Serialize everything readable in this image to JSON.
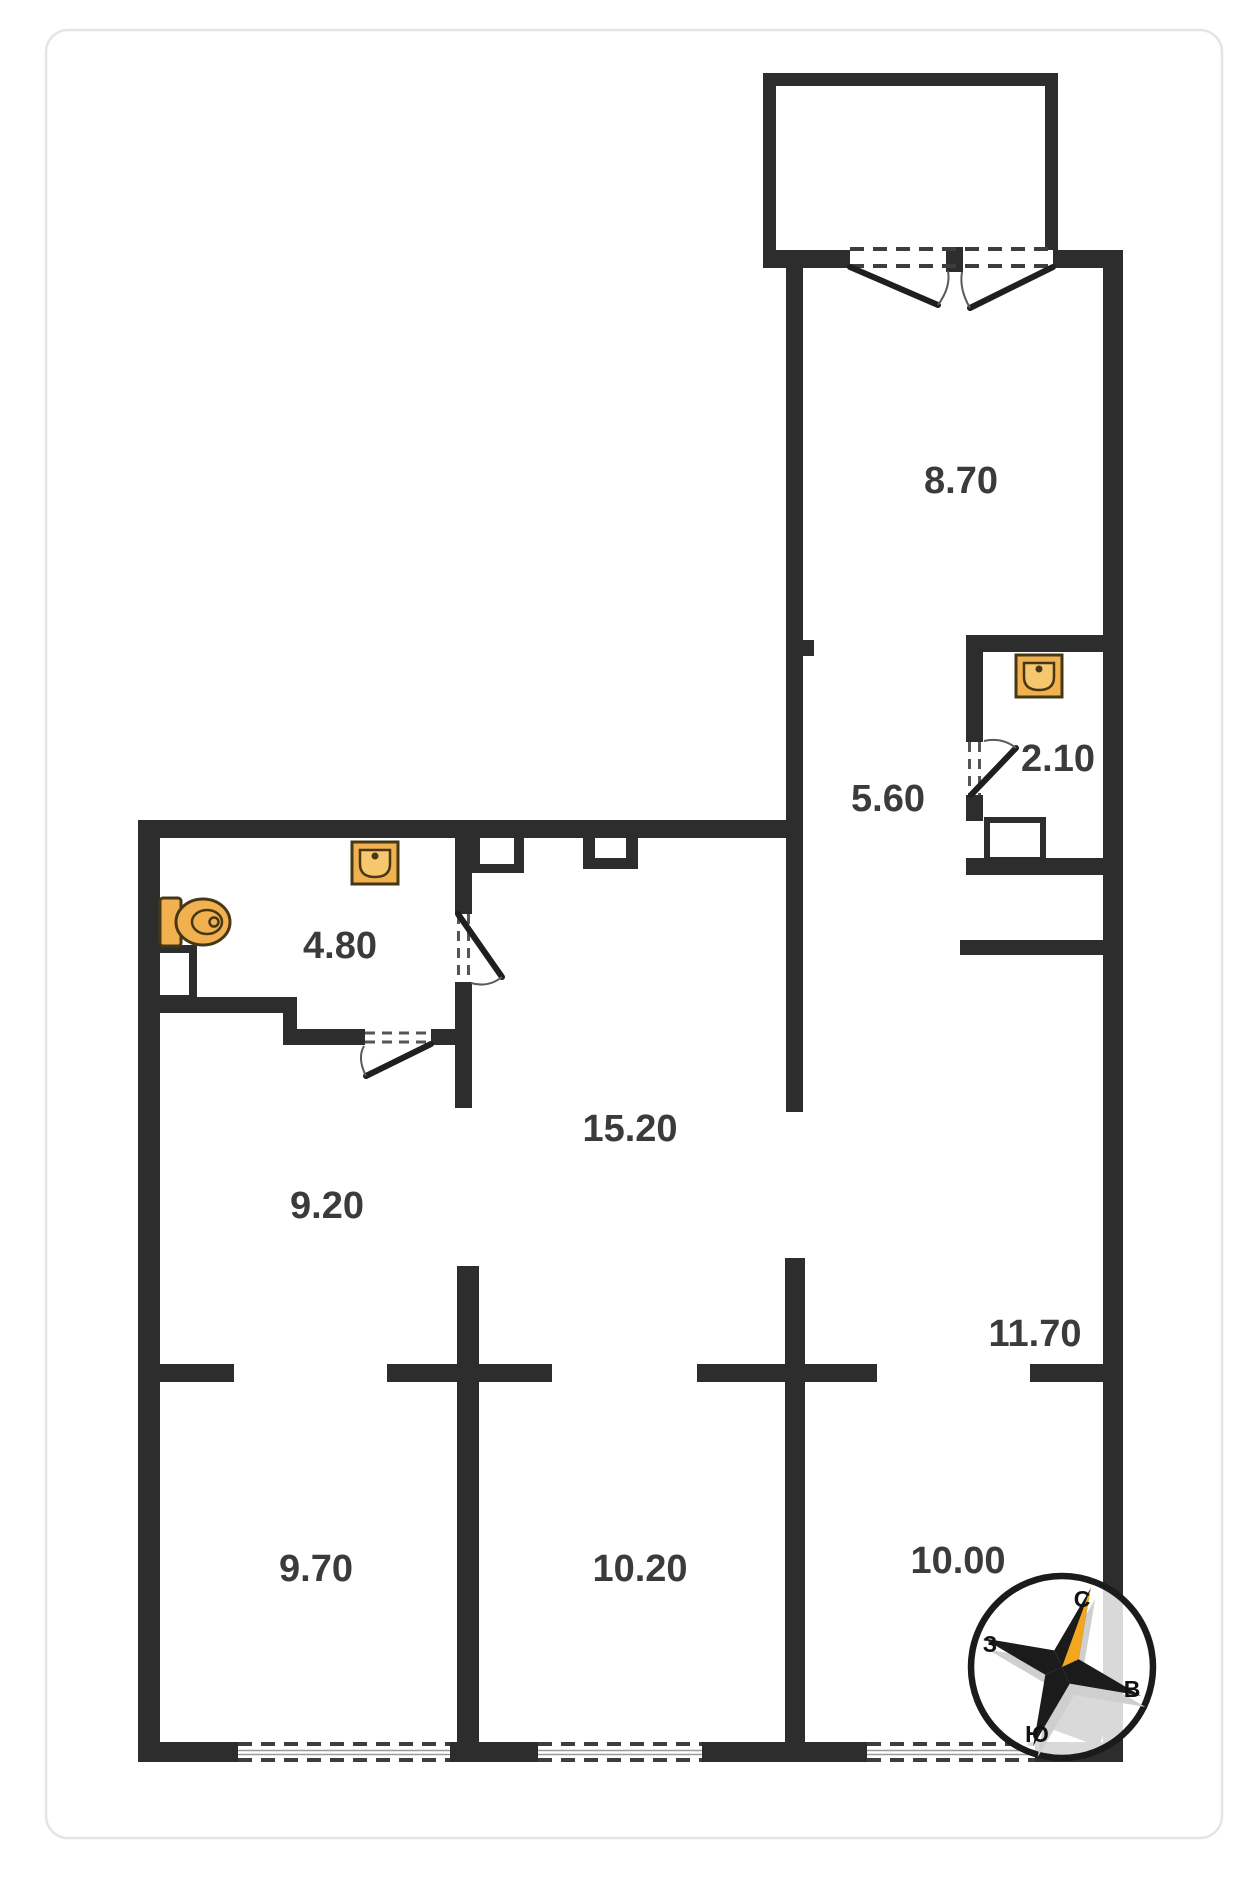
{
  "page": {
    "background": "#ffffff",
    "card_border": "#e5e5e7"
  },
  "floor_plan": {
    "room_labels": [
      {
        "id": "loggia-room",
        "area": "8.70"
      },
      {
        "id": "wc",
        "area": "2.10"
      },
      {
        "id": "hall-upper",
        "area": "5.60"
      },
      {
        "id": "bathroom",
        "area": "4.80"
      },
      {
        "id": "hall-main",
        "area": "15.20"
      },
      {
        "id": "room-a",
        "area": "9.20"
      },
      {
        "id": "room-b",
        "area": "11.70"
      },
      {
        "id": "room-c",
        "area": "9.70"
      },
      {
        "id": "room-d",
        "area": "10.20"
      },
      {
        "id": "room-e",
        "area": "10.00"
      }
    ],
    "fixtures": [
      "sink-icon",
      "sink-icon",
      "toilet-icon"
    ],
    "colors": {
      "wall": "#2d2d2d",
      "label": "#3b3b3b",
      "fixture_fill": "#f2b14f",
      "fixture_stroke": "#463817",
      "compass_accent": "#f3a71f"
    },
    "compass": {
      "north": "С",
      "east": "В",
      "south": "Ю",
      "west": "З"
    }
  }
}
